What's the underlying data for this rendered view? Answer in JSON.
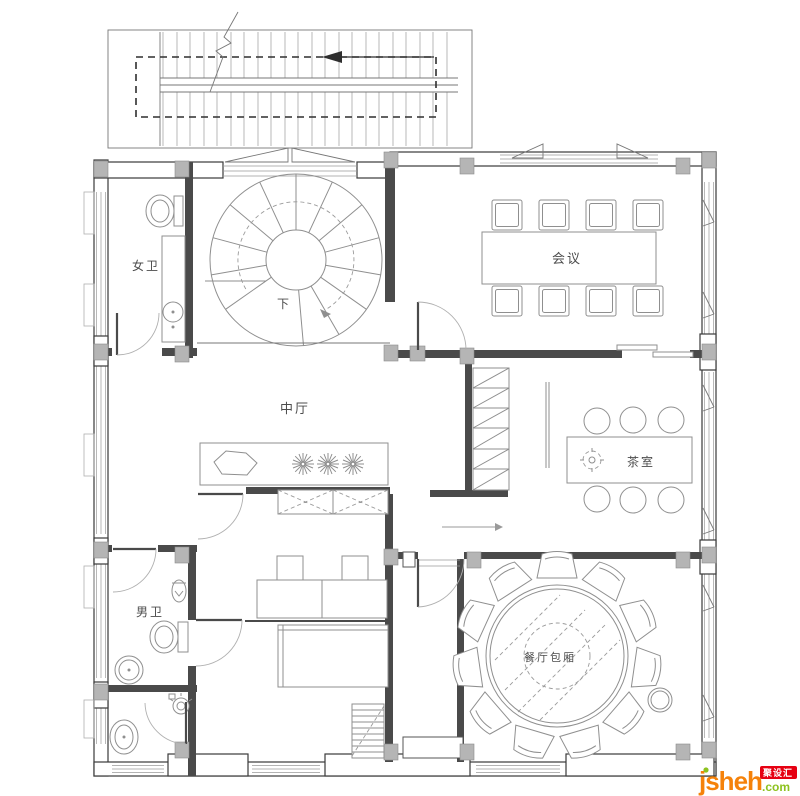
{
  "labels": {
    "women_restroom": "女卫",
    "men_restroom": "男卫",
    "central_hall": "中厅",
    "meeting_room": "会议",
    "tea_room": "茶室",
    "dining_room": "餐厅包厢",
    "stair_down": "下"
  },
  "watermark": {
    "site_name": "jsheh",
    "tld": ".com",
    "badge": "聚设汇",
    "colors": {
      "orange": "#f5820a",
      "green": "#8dc21f",
      "red": "#e60012"
    }
  }
}
